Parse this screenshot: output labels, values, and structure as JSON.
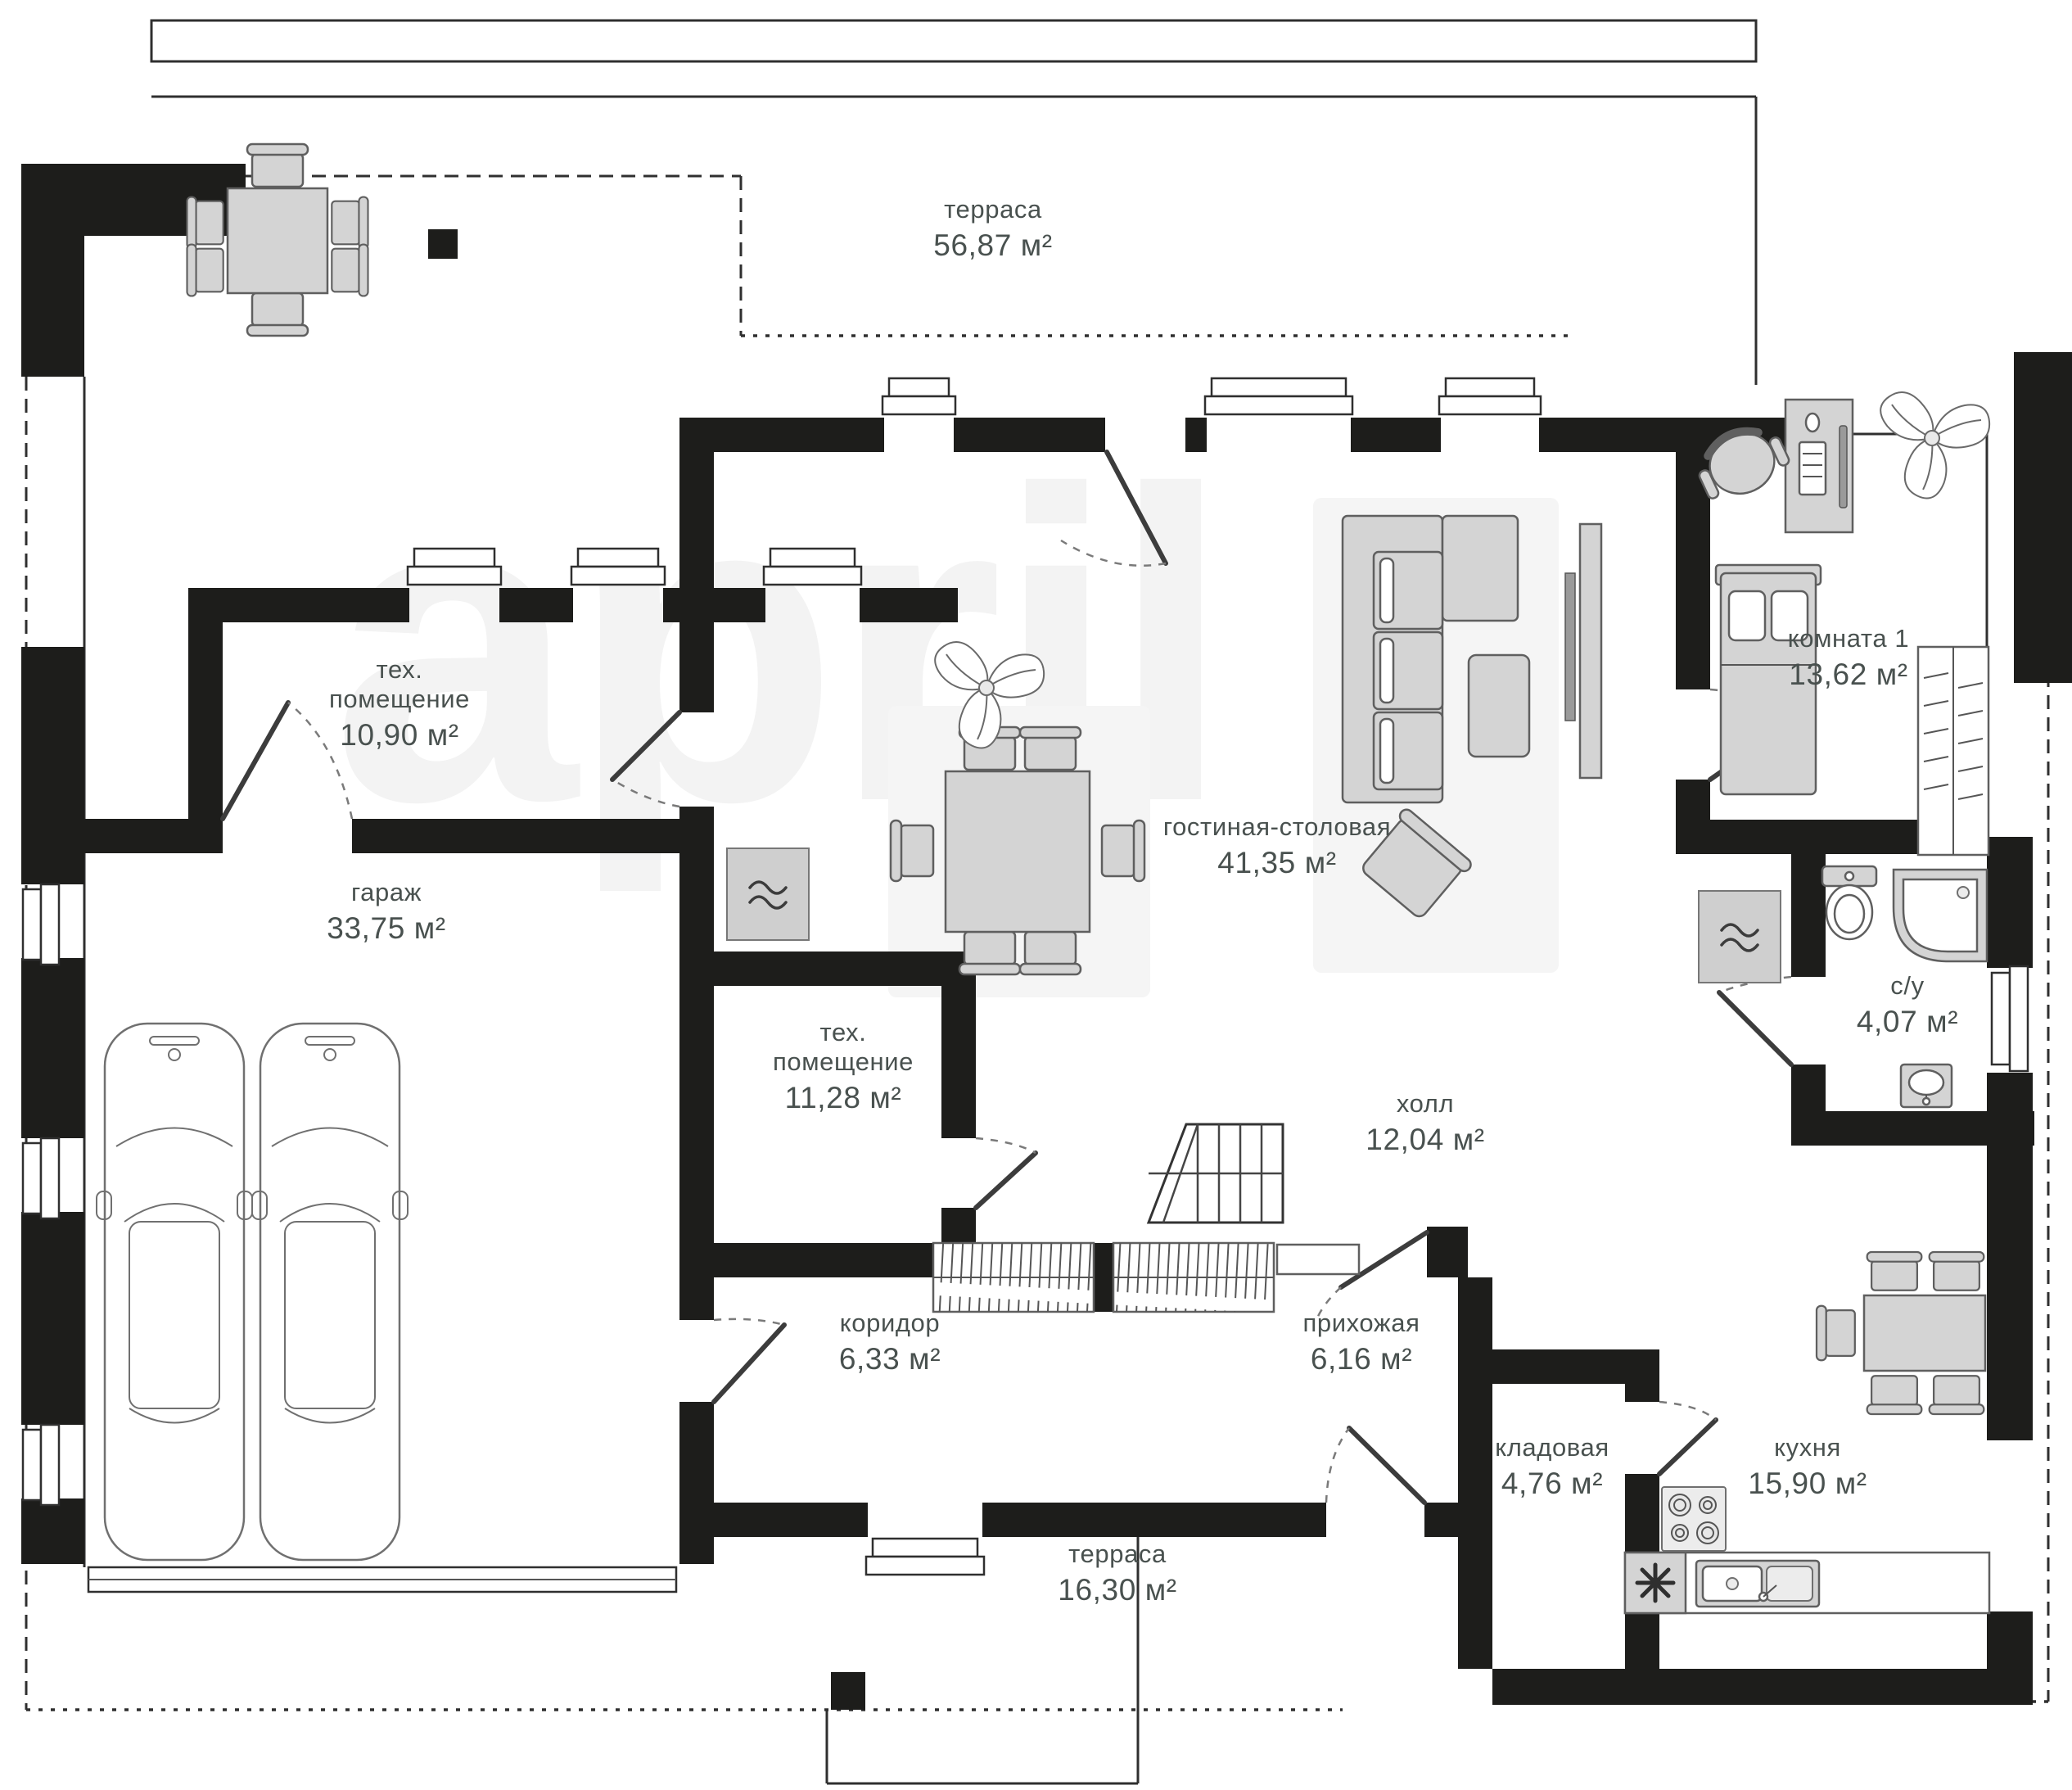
{
  "plan": {
    "watermark": "april",
    "rooms": [
      {
        "id": "terrace-top",
        "name": "терраса",
        "area": "56,87 м²"
      },
      {
        "id": "tech-room-1",
        "name": "тех. помещение",
        "area": "10,90 м²"
      },
      {
        "id": "garage",
        "name": "гараж",
        "area": "33,75 м²"
      },
      {
        "id": "living-dining",
        "name": "гостиная-столовая",
        "area": "41,35 м²"
      },
      {
        "id": "room-1",
        "name": "комната 1",
        "area": "13,62 м²"
      },
      {
        "id": "tech-room-2",
        "name": "тех. помещение",
        "area": "11,28 м²"
      },
      {
        "id": "hall",
        "name": "холл",
        "area": "12,04 м²"
      },
      {
        "id": "bathroom",
        "name": "с/у",
        "area": "4,07 м²"
      },
      {
        "id": "corridor",
        "name": "коридор",
        "area": "6,33 м²"
      },
      {
        "id": "entry-hall",
        "name": "прихожая",
        "area": "6,16 м²"
      },
      {
        "id": "pantry",
        "name": "кладовая",
        "area": "4,76 м²"
      },
      {
        "id": "kitchen",
        "name": "кухня",
        "area": "15,90 м²"
      },
      {
        "id": "terrace-bottom",
        "name": "терраса",
        "area": "16,30 м²"
      }
    ],
    "colors": {
      "wall": "#1d1d1b",
      "furniture": "#d4d4d4",
      "furnitureStroke": "#5f5f5f",
      "label": "#49514f",
      "watermark": "#f3f3f3"
    }
  }
}
